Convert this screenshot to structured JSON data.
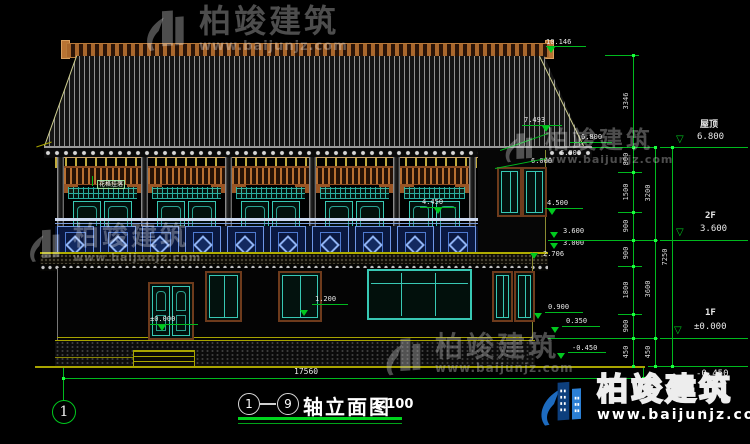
{
  "drawing": {
    "title": "轴立面图",
    "axis_from": "1",
    "axis_to": "9",
    "scale": "1:100",
    "sheet_no": "1",
    "total_width_dim": "17560"
  },
  "levels": {
    "roof": {
      "label": "屋顶",
      "value": "6.800"
    },
    "f2": {
      "label": "2F",
      "value": "3.600"
    },
    "f1": {
      "label": "1F",
      "value": "±0.000"
    },
    "ground": {
      "value": "-0.450"
    }
  },
  "markers": {
    "ridge_top": "10.146",
    "eave_fascia": "7.493",
    "eave_top": "6.800",
    "eave_mid": "6.000",
    "eave_low": "6.000",
    "win2f_sill": "4.500",
    "rail_top": "4.450",
    "f2_floor": "3.600",
    "waist_top": "3.000",
    "waist_bottom": "2.706",
    "win1f_sill": "1.200",
    "sill_band": "0.900",
    "plinth_top": "0.350",
    "door_base": "±0.000",
    "base_neg": "-0.450"
  },
  "dims": {
    "inner": [
      "3346",
      "800",
      "1500",
      "900",
      "900",
      "1800",
      "900",
      "450"
    ],
    "middle": [
      "3200",
      "3600",
      "450"
    ],
    "outer": [
      "7250"
    ]
  },
  "watermark": {
    "brand": "柏竣建筑",
    "url": "www.baijunjz.com"
  },
  "detail_tag": "花格挂落"
}
